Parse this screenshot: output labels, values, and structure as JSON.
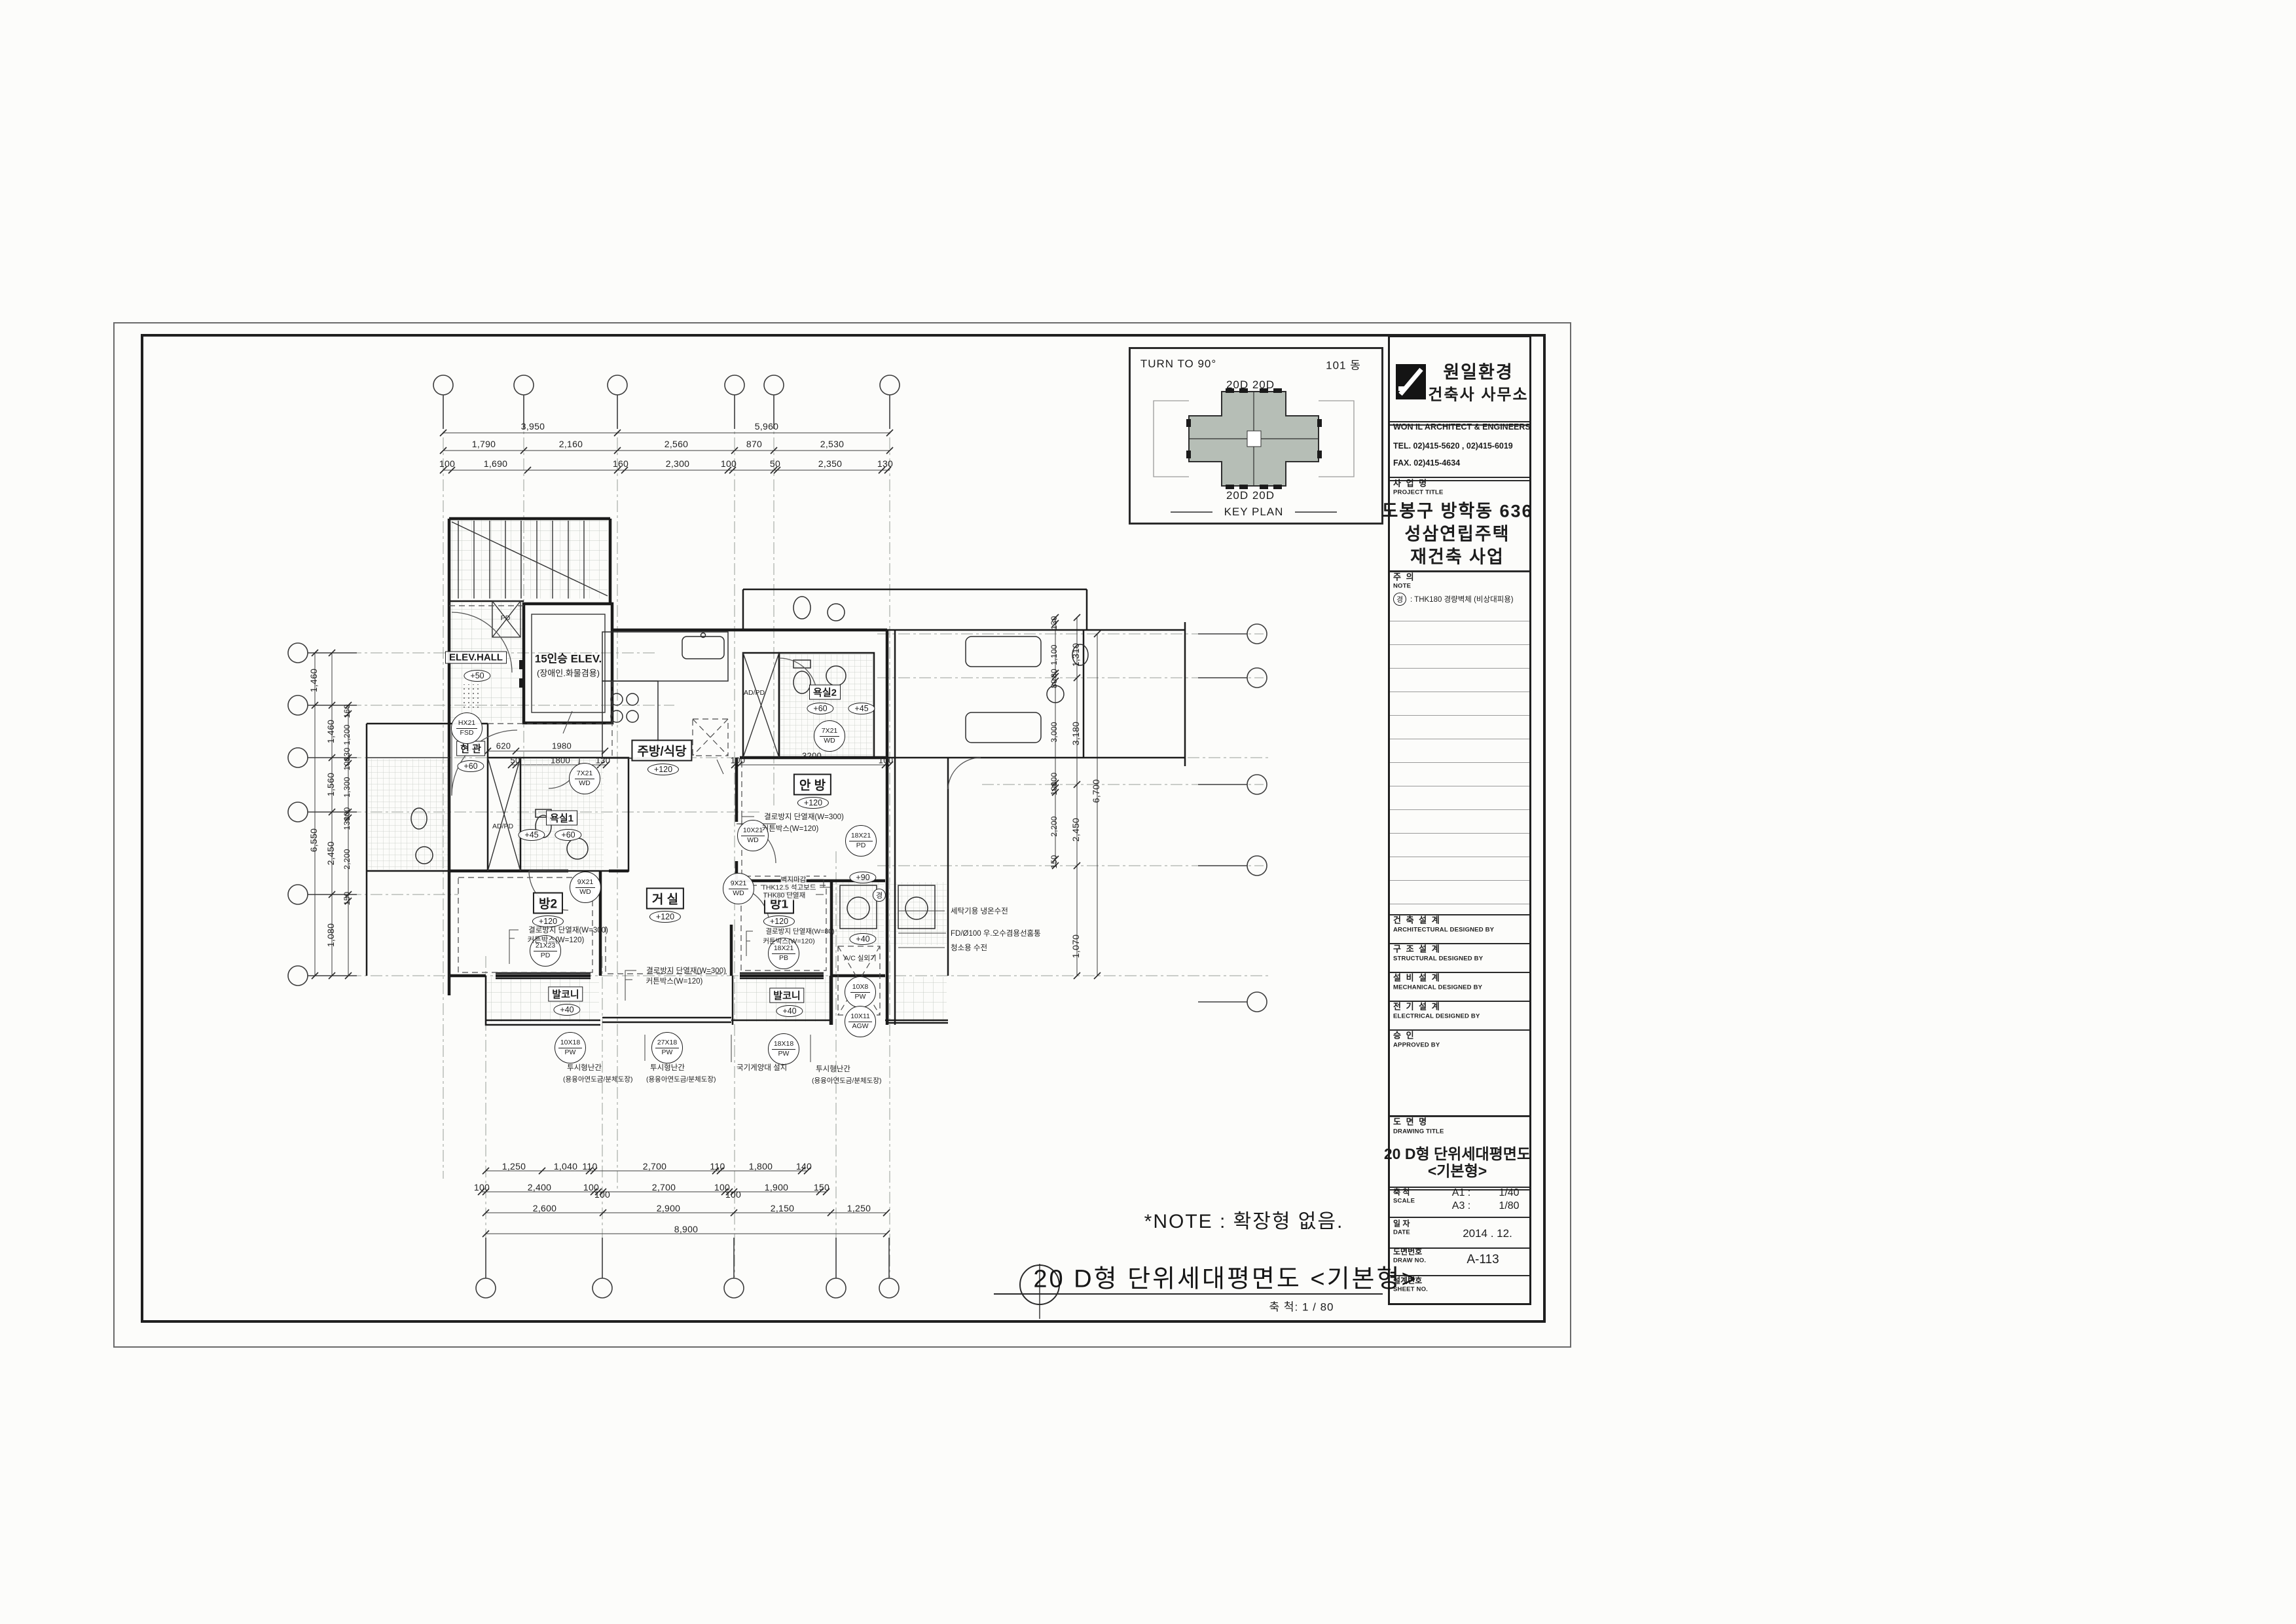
{
  "sheet": {
    "key_plan": {
      "turn_to": "TURN TO 90°",
      "building_no": "101 동",
      "top_units": "20D 20D",
      "bottom_units": "20D 20D",
      "caption": "KEY PLAN",
      "fill": "#b6beb6"
    },
    "title_block": {
      "firm_kr1": "원일환경",
      "firm_kr2": "건축사 사무소",
      "firm_en": "WON IL ARCHITECT  &  ENGINEERS",
      "tel": "TEL.    02)415-5620 , 02)415-6019",
      "fax": "FAX.    02)415-4634",
      "project_label_kr": "사  업  명",
      "project_label_en": "PROJECT TITLE",
      "project_line1": "도봉구 방학동 636",
      "project_line2": "성삼연립주택",
      "project_line3": "재건축 사업",
      "note_label_kr": "주  의",
      "note_label_en": "NOTE",
      "note_symbol": "경",
      "note_text": ": THK180 경량벽체 (비상대피용)",
      "arch_kr": "건 축 설 계",
      "arch_en": "ARCHITECTURAL DESIGNED BY",
      "struct_kr": "구 조 설 계",
      "struct_en": "STRUCTURAL DESIGNED BY",
      "mech_kr": "설 비 설 계",
      "mech_en": "MECHANICAL DESIGNED BY",
      "elec_kr": "전 기 설 계",
      "elec_en": "ELECTRICAL DESIGNED BY",
      "appr_kr": "승    인",
      "appr_en": "APPROVED BY",
      "dwg_label_kr": "도 면 명",
      "dwg_label_en": "DRAWING TITLE",
      "dwg_title1": "20 D형 단위세대평면도",
      "dwg_title2": "<기본형>",
      "scale_kr": "축    척",
      "scale_en": "SCALE",
      "scale_a1_label": "A1 :",
      "scale_a1": "1/40",
      "scale_a3_label": "A3 :",
      "scale_a3": "1/80",
      "date_kr": "일    자",
      "date_en": "DATE",
      "date_value": "2014 . 12.",
      "drawno_kr": "도면번호",
      "drawno_en": "DRAW NO.",
      "drawno_value": "A-113",
      "sheetno_kr": "설계번호",
      "sheetno_en": "SHEET NO."
    },
    "captions": {
      "note": "*NOTE : 확장형 없음.",
      "title": "20 D형 단위세대평면도 <기본형>",
      "scale": "축 척: 1 / 80"
    }
  },
  "plan": {
    "rooms": {
      "elev_hall": "ELEV.HALL",
      "elev": "15인승 ELEV.",
      "elev_sub": "(장애인.화물겸용)",
      "entry": "현 관",
      "bath1": "욕실1",
      "bath2": "욕실2",
      "kitchen": "주방/식당",
      "master": "안 방",
      "living": "거 실",
      "room1": "방1",
      "room2": "방2",
      "balcony1": "발코니",
      "balcony2": "발코니",
      "ac": "A/C 실외기",
      "adpd1": "AD/PD",
      "adpd2": "AD/PD",
      "pd": "PD"
    },
    "levels": {
      "hall": "+50",
      "entry": "+60",
      "bath1_a": "+45",
      "bath1_b": "+60",
      "bath2_a": "+60",
      "bath2_b": "+45",
      "kitchen": "+120",
      "master": "+120",
      "living": "+120",
      "room1": "+120",
      "room2": "+120",
      "balcony1": "+40",
      "balcony2": "+40",
      "util_a": "+90",
      "util_b": "+40"
    },
    "tags": {
      "entry_door": [
        "HX21",
        "FSD"
      ],
      "bath1_door": [
        "7X21",
        "WD"
      ],
      "bath2_door": [
        "7X21",
        "WD"
      ],
      "master_door": [
        "10X21",
        "WD"
      ],
      "room1_door": [
        "9X21",
        "WD"
      ],
      "room2_door": [
        "9X21",
        "WD"
      ],
      "master_balcony": [
        "18X21",
        "PD"
      ],
      "room2_balcony": [
        "21X23",
        "PD"
      ],
      "room1_pb": [
        "18X21",
        "PB"
      ],
      "balcony1_win": [
        "10X18",
        "PW"
      ],
      "living_win": [
        "27X18",
        "PW"
      ],
      "balcony2_win": [
        "18X18",
        "PW"
      ],
      "util_win": [
        "10X8",
        "PW"
      ],
      "util_agw": [
        "10X11",
        "AGW"
      ],
      "sym": "경"
    },
    "notes": {
      "master_n1": "결로방지 단열재(W=300)",
      "master_n2": "커튼박스(W=120)",
      "room2_n1": "결로방지 단열재(W=300)",
      "room2_n2": "커튼박스(W=120)",
      "living_n1": "결로방지 단열재(W=300)",
      "living_n2": "커튼박스(W=120)",
      "room1_n1": "벽지마감",
      "room1_n2": "THK12.5 석고보드",
      "room1_n3": "THK80 단열재",
      "room1_n4": "결로방지 단열재(W=80)",
      "room1_n5": "커튼박스(W=120)",
      "side_n1": "세탁기용 냉온수전",
      "side_n2": "FD/Ø100 우.오수겸용선홈통",
      "side_n3": "청소용 수전",
      "rail1": "투시형난간",
      "rail1b": "(용융아연도금/분체도장)",
      "rail2": "투시형난간",
      "rail2b": "(용융아연도금/분체도장)",
      "rail3": "투시형난간",
      "rail3b": "(용융아연도금/분체도장)",
      "flag": "국기게양대 설치"
    },
    "dims": {
      "top1": [
        "3,950",
        "5,960"
      ],
      "top2": [
        "1,790",
        "2,160",
        "2,560",
        "870",
        "2,530"
      ],
      "top3": [
        "100",
        "1,690",
        "160",
        "2,300",
        "100",
        "50",
        "2,350",
        "130"
      ],
      "inner_top": [
        "620",
        "1980",
        "50",
        "1800",
        "130"
      ],
      "inner_master": [
        "100",
        "3200",
        "100"
      ],
      "bottom1": [
        "1,250",
        "1,040",
        "110",
        "2,700",
        "110",
        "1,800",
        "140"
      ],
      "bottom2": [
        "100",
        "2,400",
        "100",
        "100",
        "2,700",
        "100",
        "100",
        "1,900",
        "150"
      ],
      "bottom3": [
        "2,600",
        "2,900",
        "2,150",
        "1,250"
      ],
      "bottom4": [
        "8,900"
      ],
      "left1": [
        "1,460",
        "6,550"
      ],
      "left2": [
        "1,460",
        "1,560",
        "2,450",
        "1,080"
      ],
      "left3": [
        "160",
        "1,200",
        "130",
        "100",
        "1,300",
        "100",
        "130",
        "2,200",
        "150"
      ],
      "right1": [
        "130",
        "1,100",
        "80",
        "80",
        "3,000",
        "100",
        "100",
        "2,200",
        "150"
      ],
      "right2": [
        "1,310",
        "3,180",
        "2,450"
      ],
      "right3": [
        "6,700",
        "1,070"
      ]
    }
  }
}
